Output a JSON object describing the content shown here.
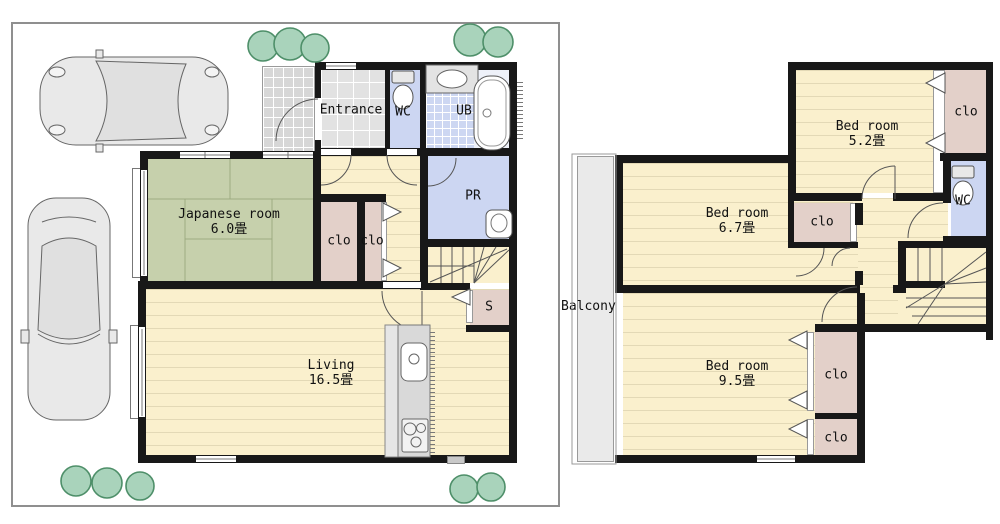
{
  "floor1": {
    "rooms": {
      "entrance": {
        "label": "Entrance"
      },
      "wc": {
        "label": "WC"
      },
      "bath": {
        "label": "UB"
      },
      "powder": {
        "label": "PR"
      },
      "japanese": {
        "label": "Japanese room",
        "size": "6.0畳"
      },
      "living": {
        "label": "Living",
        "size": "16.5畳"
      },
      "closet_a": {
        "label": "clo"
      },
      "closet_b": {
        "label": "clo"
      },
      "storage": {
        "label": "S"
      }
    }
  },
  "floor2": {
    "rooms": {
      "bed_52": {
        "label": "Bed room",
        "size": "5.2畳"
      },
      "bed_67": {
        "label": "Bed room",
        "size": "6.7畳"
      },
      "bed_95": {
        "label": "Bed room",
        "size": "9.5畳"
      },
      "closet_52": {
        "label": "clo"
      },
      "closet_67": {
        "label": "clo"
      },
      "closet_95a": {
        "label": "clo"
      },
      "closet_95b": {
        "label": "clo"
      },
      "wc": {
        "label": "WC"
      },
      "balcony": {
        "label": "Balcony"
      }
    }
  },
  "colors": {
    "wall": "#181818",
    "tatami": "#c6d0ac",
    "wood_floor": "#faf0cd",
    "wet_room": "#ccd6f2",
    "closet": "#e3d0c9",
    "porch_tile": "#d7d7d7",
    "entrance_tile": "#e2e2e2",
    "balcony": "#eaeaea",
    "counter": "#d9d9d9",
    "tree_fill": "#a9d3bb",
    "tree_stroke": "#4e8f69",
    "boundary": "#8f8f8f"
  }
}
